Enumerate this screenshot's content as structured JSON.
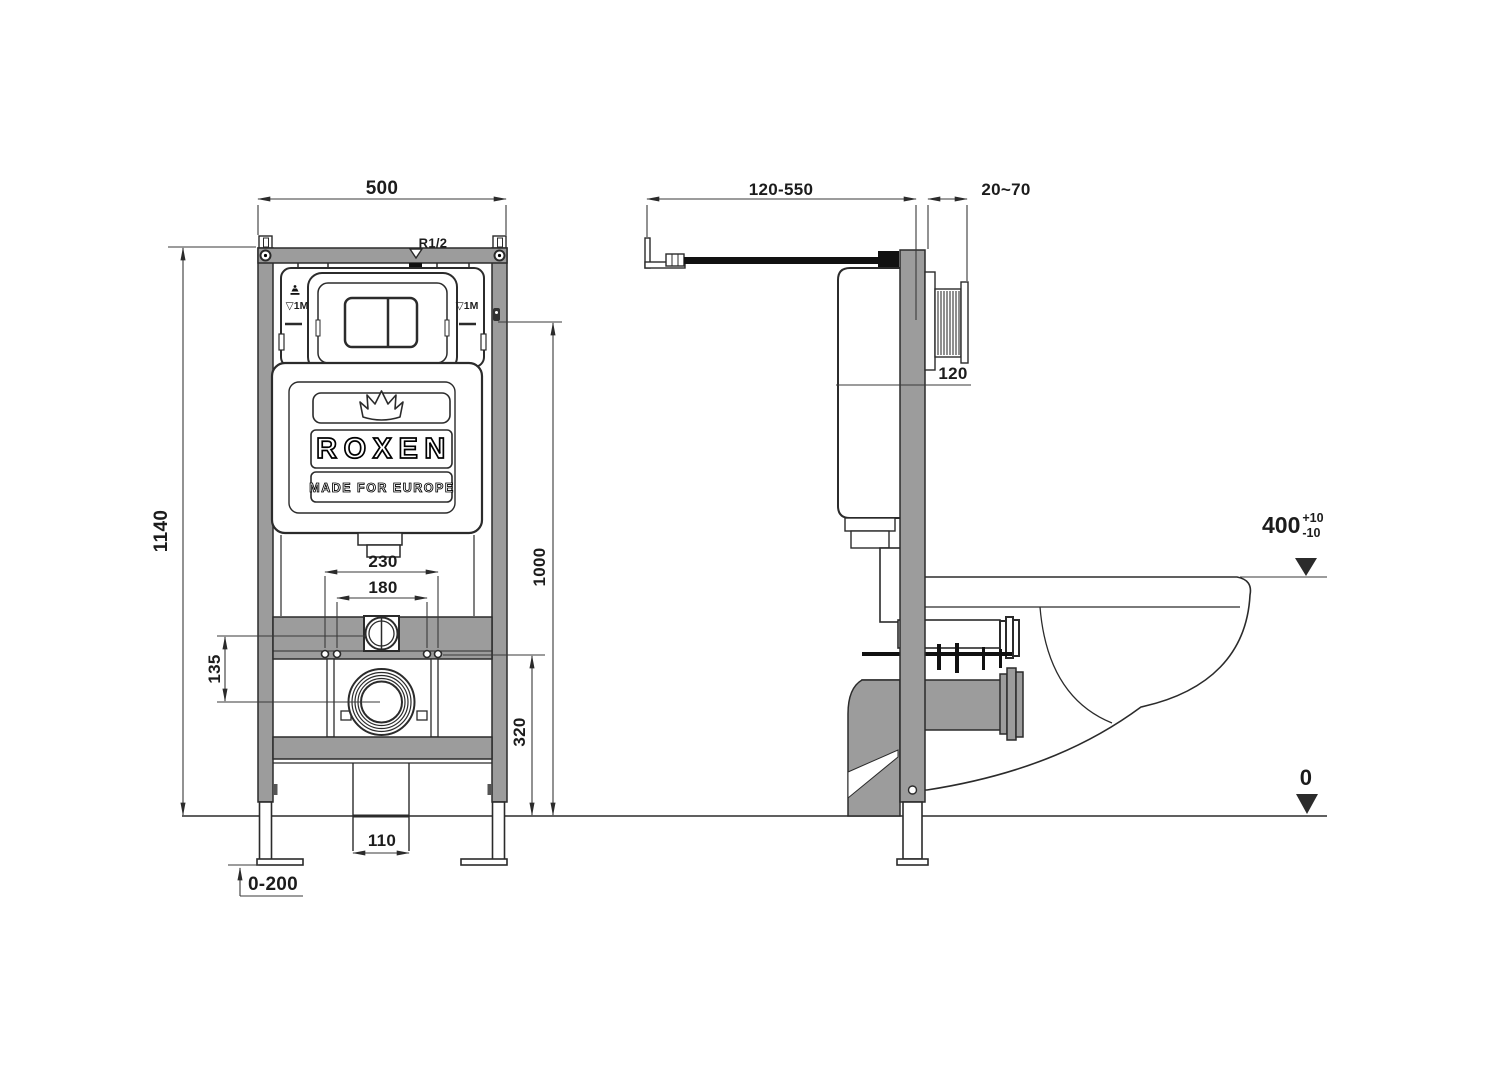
{
  "colors": {
    "frame-gray": "#9c9c9c",
    "line": "#2b2b2b",
    "dim-text": "#1c1c1c",
    "pipe-black": "#111111"
  },
  "brand": {
    "name": "ROXEN",
    "tagline": "MADE FOR EUROPE"
  },
  "front_view": {
    "dim_width": "500",
    "dim_height": "1140",
    "dim_plate_center": "1000",
    "dim_bolt_outer": "230",
    "dim_bolt_inner": "180",
    "dim_offset": "135",
    "dim_bolt_height": "320",
    "dim_drain_pipe": "110",
    "dim_leg_adjust": "0-200",
    "label_thread": "R1/2",
    "label_level_left": "▽1M",
    "label_level_right": "▽1M"
  },
  "side_view": {
    "dim_depth": "120-550",
    "dim_wall": "20~70",
    "dim_tank_depth": "120",
    "rim_level": {
      "value": "400",
      "tol_plus": "+10",
      "tol_minus": "-10"
    },
    "floor_level": "0"
  }
}
